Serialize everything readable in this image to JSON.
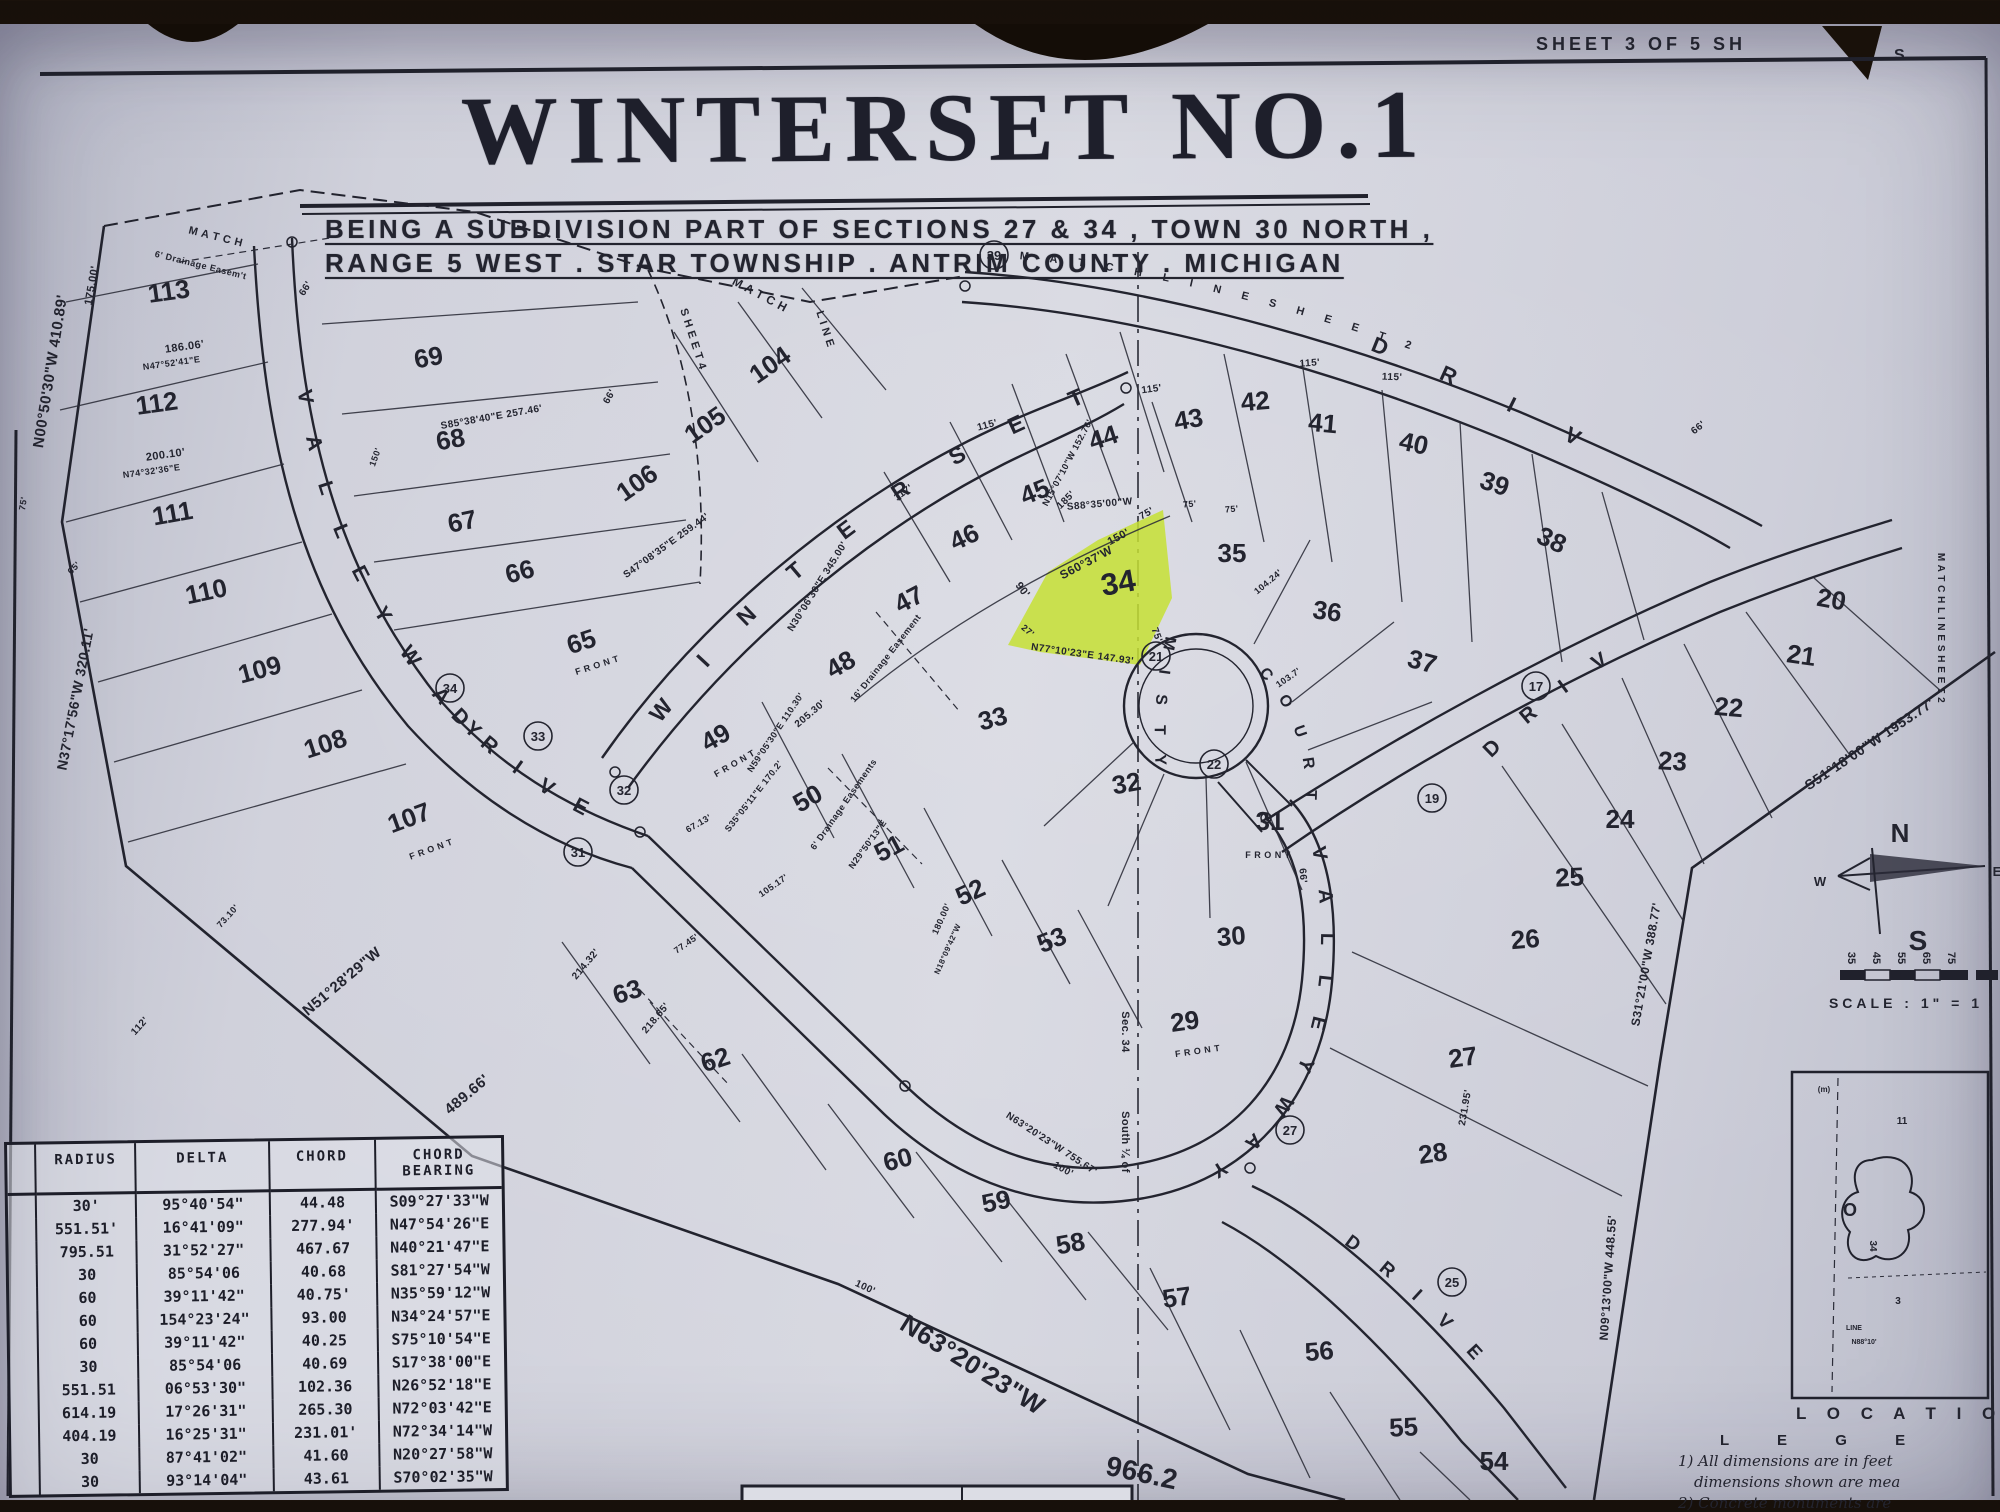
{
  "page": {
    "sheet_label": "SHEET 3 OF 5 SH",
    "sheet_label_torn": "S",
    "title": "WINTERSET NO.1",
    "subtitle_line1": "BEING A SUBDIVISION PART OF SECTIONS 27 & 34 , TOWN 30 NORTH ,",
    "subtitle_line2": "RANGE 5 WEST . STAR TOWNSHIP . ANTRIM COUNTY . MICHIGAN",
    "paper_color": "#d2d3dc",
    "ink_color": "#23242f",
    "highlight_color": "#c6e034"
  },
  "map": {
    "streets": [
      {
        "path": "#lp-left",
        "offset": "8%",
        "size": 21,
        "spacing": 14,
        "label": "V A L L E Y W A Y"
      },
      {
        "path": "#lp-left",
        "offset": "70%",
        "size": 21,
        "spacing": 10,
        "label": "D R I V E"
      },
      {
        "path": "#lp-winterset",
        "offset": "5%",
        "size": 23,
        "spacing": 22,
        "label": "W I N T E R S E T"
      },
      {
        "path": "#lp-match-tr",
        "offset": "2%",
        "size": 11,
        "spacing": 9,
        "label": "M A T C H   L I N E   S H E E T   2"
      },
      {
        "path": "#lp-drive-tr",
        "offset": "8%",
        "size": 22,
        "spacing": 26,
        "label": "D R I V E"
      },
      {
        "path": "#lp-drive-right",
        "offset": "5%",
        "size": 21,
        "spacing": 14,
        "label": "D R I V E"
      },
      {
        "path": "#lp-loop",
        "offset": "2%",
        "size": 20,
        "spacing": 12,
        "label": "V A L L E Y W A Y"
      },
      {
        "path": "#lp-exit",
        "offset": "16%",
        "size": 19,
        "spacing": 12,
        "label": "D R I V E"
      },
      {
        "path": "#lp-misty",
        "offset": "0%",
        "size": 16,
        "spacing": 8,
        "label": "M I S T Y"
      },
      {
        "path": "#lp-court",
        "offset": "4%",
        "size": 16,
        "spacing": 8,
        "label": "C O U R T"
      }
    ],
    "lots": [
      {
        "n": "113",
        "x": 170,
        "y": 300,
        "r": -8
      },
      {
        "n": "112",
        "x": 158,
        "y": 412,
        "r": -8
      },
      {
        "n": "111",
        "x": 174,
        "y": 522,
        "r": -10
      },
      {
        "n": "110",
        "x": 208,
        "y": 600,
        "r": -12
      },
      {
        "n": "109",
        "x": 262,
        "y": 678,
        "r": -15
      },
      {
        "n": "108",
        "x": 328,
        "y": 752,
        "r": -18
      },
      {
        "n": "107",
        "x": 412,
        "y": 826,
        "r": -20
      },
      {
        "n": "69",
        "x": 430,
        "y": 366,
        "r": -10
      },
      {
        "n": "68",
        "x": 452,
        "y": 448,
        "r": -10
      },
      {
        "n": "67",
        "x": 464,
        "y": 530,
        "r": -12
      },
      {
        "n": "66",
        "x": 522,
        "y": 580,
        "r": -15
      },
      {
        "n": "65",
        "x": 584,
        "y": 650,
        "r": -18
      },
      {
        "n": "104",
        "x": 775,
        "y": 372,
        "r": -35
      },
      {
        "n": "105",
        "x": 710,
        "y": 432,
        "r": -35
      },
      {
        "n": "106",
        "x": 642,
        "y": 490,
        "r": -35
      },
      {
        "n": "48",
        "x": 845,
        "y": 672,
        "r": -30
      },
      {
        "n": "47",
        "x": 913,
        "y": 607,
        "r": -28
      },
      {
        "n": "46",
        "x": 968,
        "y": 545,
        "r": -25
      },
      {
        "n": "45",
        "x": 1038,
        "y": 500,
        "r": -22
      },
      {
        "n": "44",
        "x": 1106,
        "y": 446,
        "r": -18
      },
      {
        "n": "43",
        "x": 1190,
        "y": 428,
        "r": -10
      },
      {
        "n": "42",
        "x": 1256,
        "y": 410,
        "r": -5
      },
      {
        "n": "41",
        "x": 1322,
        "y": 432,
        "r": 5
      },
      {
        "n": "40",
        "x": 1412,
        "y": 452,
        "r": 12
      },
      {
        "n": "39",
        "x": 1492,
        "y": 492,
        "r": 18
      },
      {
        "n": "38",
        "x": 1548,
        "y": 548,
        "r": 25
      },
      {
        "n": "35",
        "x": 1232,
        "y": 562,
        "r": 0
      },
      {
        "n": "36",
        "x": 1326,
        "y": 620,
        "r": 8
      },
      {
        "n": "37",
        "x": 1420,
        "y": 670,
        "r": 15
      },
      {
        "n": "34",
        "x": 1120,
        "y": 593,
        "r": -10,
        "s": 31
      },
      {
        "n": "33",
        "x": 995,
        "y": 727,
        "r": -15
      },
      {
        "n": "32",
        "x": 1128,
        "y": 792,
        "r": -10
      },
      {
        "n": "31",
        "x": 1270,
        "y": 830,
        "r": 0
      },
      {
        "n": "30",
        "x": 1232,
        "y": 945,
        "r": -5
      },
      {
        "n": "29",
        "x": 1186,
        "y": 1030,
        "r": -8
      },
      {
        "n": "49",
        "x": 720,
        "y": 745,
        "r": -30
      },
      {
        "n": "50",
        "x": 812,
        "y": 806,
        "r": -30
      },
      {
        "n": "51",
        "x": 893,
        "y": 856,
        "r": -28
      },
      {
        "n": "52",
        "x": 974,
        "y": 900,
        "r": -25
      },
      {
        "n": "53",
        "x": 1055,
        "y": 948,
        "r": -22
      },
      {
        "n": "63",
        "x": 630,
        "y": 1000,
        "r": -18
      },
      {
        "n": "62",
        "x": 718,
        "y": 1068,
        "r": -18
      },
      {
        "n": "60",
        "x": 900,
        "y": 1168,
        "r": -15
      },
      {
        "n": "59",
        "x": 998,
        "y": 1210,
        "r": -12
      },
      {
        "n": "58",
        "x": 1072,
        "y": 1252,
        "r": -10
      },
      {
        "n": "57",
        "x": 1178,
        "y": 1306,
        "r": -8
      },
      {
        "n": "56",
        "x": 1320,
        "y": 1360,
        "r": -5
      },
      {
        "n": "55",
        "x": 1404,
        "y": 1436,
        "r": -3
      },
      {
        "n": "54",
        "x": 1494,
        "y": 1470,
        "r": 0
      },
      {
        "n": "20",
        "x": 1830,
        "y": 608,
        "r": 10
      },
      {
        "n": "21",
        "x": 1800,
        "y": 664,
        "r": 8
      },
      {
        "n": "22",
        "x": 1728,
        "y": 716,
        "r": 5
      },
      {
        "n": "23",
        "x": 1672,
        "y": 770,
        "r": 3
      },
      {
        "n": "24",
        "x": 1620,
        "y": 828,
        "r": 0
      },
      {
        "n": "25",
        "x": 1570,
        "y": 886,
        "r": -3
      },
      {
        "n": "26",
        "x": 1526,
        "y": 948,
        "r": -5
      },
      {
        "n": "27",
        "x": 1464,
        "y": 1066,
        "r": -8
      },
      {
        "n": "28",
        "x": 1434,
        "y": 1162,
        "r": -8
      }
    ],
    "circled": [
      {
        "n": "39",
        "x": 994,
        "y": 255
      },
      {
        "n": "34",
        "x": 450,
        "y": 688
      },
      {
        "n": "33",
        "x": 538,
        "y": 736
      },
      {
        "n": "32",
        "x": 624,
        "y": 790
      },
      {
        "n": "31",
        "x": 578,
        "y": 852
      },
      {
        "n": "21",
        "x": 1156,
        "y": 656
      },
      {
        "n": "22",
        "x": 1214,
        "y": 764
      },
      {
        "n": "17",
        "x": 1536,
        "y": 686
      },
      {
        "n": "19",
        "x": 1432,
        "y": 798
      },
      {
        "n": "25",
        "x": 1452,
        "y": 1282
      },
      {
        "n": "27",
        "x": 1290,
        "y": 1130
      }
    ],
    "labels": [
      {
        "t": "N00°50'30\"W  410.89'",
        "x": 55,
        "y": 372,
        "r": -81,
        "s": 15
      },
      {
        "t": "175.00'",
        "x": 95,
        "y": 286,
        "r": -80,
        "s": 11
      },
      {
        "t": "N37°17'56\"W  320.11'",
        "x": 80,
        "y": 700,
        "r": -79,
        "s": 14
      },
      {
        "t": "N51°28'29\"W",
        "x": 345,
        "y": 985,
        "r": -40,
        "s": 15
      },
      {
        "t": "489.66'",
        "x": 470,
        "y": 1098,
        "r": -40,
        "s": 15
      },
      {
        "t": "N63°20'23\"W",
        "x": 968,
        "y": 1372,
        "r": 32,
        "s": 26
      },
      {
        "t": "966.2",
        "x": 1140,
        "y": 1482,
        "r": 12,
        "s": 28
      },
      {
        "t": "S51°18'00\"W  1953.77'",
        "x": 1872,
        "y": 748,
        "r": -34,
        "s": 14
      },
      {
        "t": "S31°21'00\"W  388.77'",
        "x": 1650,
        "y": 965,
        "r": -80,
        "s": 12
      },
      {
        "t": "N09°13'00\"W  448.55'",
        "x": 1612,
        "y": 1278,
        "r": -86,
        "s": 12
      },
      {
        "t": "M A T C H   L I N E   S H E E T   2",
        "x": 1938,
        "y": 628,
        "r": 90,
        "s": 10
      },
      {
        "t": "S88°35'00\"W",
        "x": 1100,
        "y": 507,
        "r": -5,
        "s": 10
      },
      {
        "t": "75'",
        "x": 1190,
        "y": 507,
        "r": -5,
        "s": 9
      },
      {
        "t": "75'",
        "x": 1232,
        "y": 512,
        "r": -5,
        "s": 9
      },
      {
        "t": "S60°37'W",
        "x": 1088,
        "y": 566,
        "r": -28,
        "s": 12
      },
      {
        "t": "150'",
        "x": 1120,
        "y": 540,
        "r": -28,
        "s": 11
      },
      {
        "t": "75'",
        "x": 1148,
        "y": 516,
        "r": -30,
        "s": 10
      },
      {
        "t": "N77°10'23\"E  147.93'",
        "x": 1082,
        "y": 657,
        "r": 8,
        "s": 10
      },
      {
        "t": "90'",
        "x": 1020,
        "y": 592,
        "r": 52,
        "s": 11
      },
      {
        "t": "27'",
        "x": 1026,
        "y": 633,
        "r": 40,
        "s": 9
      },
      {
        "t": "75'",
        "x": 1154,
        "y": 636,
        "r": 70,
        "s": 10
      },
      {
        "t": "F R O N T",
        "x": 432,
        "y": 852,
        "r": -20,
        "s": 9
      },
      {
        "t": "F R O N T",
        "x": 598,
        "y": 668,
        "r": -18,
        "s": 9
      },
      {
        "t": "F R O N T",
        "x": 736,
        "y": 766,
        "r": -30,
        "s": 9
      },
      {
        "t": "F R O N T",
        "x": 1268,
        "y": 858,
        "r": 0,
        "s": 9
      },
      {
        "t": "F R O N T",
        "x": 1198,
        "y": 1054,
        "r": -8,
        "s": 9
      },
      {
        "t": "M A T C H",
        "x": 215,
        "y": 240,
        "r": 14,
        "s": 11
      },
      {
        "t": "M A T C H",
        "x": 758,
        "y": 298,
        "r": 28,
        "s": 12
      },
      {
        "t": "S H E E T  4",
        "x": 690,
        "y": 340,
        "r": 72,
        "s": 11
      },
      {
        "t": "L I N E",
        "x": 822,
        "y": 330,
        "r": 72,
        "s": 11
      },
      {
        "t": "6' Drainage Easem't",
        "x": 200,
        "y": 268,
        "r": 14,
        "s": 9
      },
      {
        "t": "6' Drainage Easements",
        "x": 846,
        "y": 806,
        "r": -55,
        "s": 9
      },
      {
        "t": "16' Drainage Easement",
        "x": 888,
        "y": 660,
        "r": -52,
        "s": 9
      },
      {
        "t": "Sec. 34",
        "x": 1122,
        "y": 1032,
        "r": 90,
        "s": 11
      },
      {
        "t": "South ¼ of",
        "x": 1122,
        "y": 1142,
        "r": 90,
        "s": 11
      },
      {
        "t": "N63°20'23\"W  755.67'",
        "x": 1050,
        "y": 1146,
        "r": 33,
        "s": 10
      },
      {
        "t": "S85°38'40\"E  257.46'",
        "x": 492,
        "y": 420,
        "r": -10,
        "s": 10
      },
      {
        "t": "S47°08'35\"E  259.44'",
        "x": 668,
        "y": 548,
        "r": -36,
        "s": 10
      },
      {
        "t": "N30°06'30\"E  345.00'",
        "x": 820,
        "y": 588,
        "r": -58,
        "s": 10
      },
      {
        "t": "185'",
        "x": 1068,
        "y": 502,
        "r": -45,
        "s": 10
      },
      {
        "t": "N15°07'10\"W  152.76'",
        "x": 1070,
        "y": 464,
        "r": -62,
        "s": 9
      },
      {
        "t": "115'",
        "x": 988,
        "y": 428,
        "r": -15,
        "s": 10
      },
      {
        "t": "115'",
        "x": 1152,
        "y": 392,
        "r": -8,
        "s": 10
      },
      {
        "t": "115'",
        "x": 1310,
        "y": 366,
        "r": -4,
        "s": 10
      },
      {
        "t": "115'",
        "x": 1392,
        "y": 380,
        "r": 2,
        "s": 10
      },
      {
        "t": "117'",
        "x": 905,
        "y": 495,
        "r": -35,
        "s": 10
      },
      {
        "t": "205.30'",
        "x": 812,
        "y": 716,
        "r": -40,
        "s": 10
      },
      {
        "t": "N59°05'30\"E  110.30'",
        "x": 778,
        "y": 734,
        "r": -56,
        "s": 9
      },
      {
        "t": "S35°05'11\"E  170.2'",
        "x": 756,
        "y": 798,
        "r": -52,
        "s": 9
      },
      {
        "t": "67.13'",
        "x": 700,
        "y": 826,
        "r": -30,
        "s": 9
      },
      {
        "t": "N29°50'13\"E",
        "x": 870,
        "y": 846,
        "r": -54,
        "s": 9
      },
      {
        "t": "77.45'",
        "x": 688,
        "y": 946,
        "r": -35,
        "s": 9
      },
      {
        "t": "214.32'",
        "x": 588,
        "y": 966,
        "r": -50,
        "s": 10
      },
      {
        "t": "218.65'",
        "x": 658,
        "y": 1020,
        "r": -50,
        "s": 10
      },
      {
        "t": "100'",
        "x": 864,
        "y": 1290,
        "r": 25,
        "s": 10
      },
      {
        "t": "100'",
        "x": 1062,
        "y": 1172,
        "r": 28,
        "s": 10
      },
      {
        "t": "180.00'",
        "x": 944,
        "y": 920,
        "r": -66,
        "s": 9
      },
      {
        "t": "105.17'",
        "x": 775,
        "y": 888,
        "r": -35,
        "s": 9
      },
      {
        "t": "N18°09'42\"W",
        "x": 950,
        "y": 950,
        "r": -66,
        "s": 8
      },
      {
        "t": "231.95'",
        "x": 1468,
        "y": 1108,
        "r": -80,
        "s": 10
      },
      {
        "t": "73.10'",
        "x": 230,
        "y": 918,
        "r": -48,
        "s": 9
      },
      {
        "t": "112'",
        "x": 142,
        "y": 1028,
        "r": -48,
        "s": 10
      },
      {
        "t": "75'",
        "x": 26,
        "y": 504,
        "r": -80,
        "s": 9
      },
      {
        "t": "65'",
        "x": 76,
        "y": 570,
        "r": -45,
        "s": 9
      },
      {
        "t": "66'",
        "x": 308,
        "y": 290,
        "r": -58,
        "s": 10
      },
      {
        "t": "66'",
        "x": 612,
        "y": 398,
        "r": -60,
        "s": 10
      },
      {
        "t": "66'",
        "x": 1300,
        "y": 876,
        "r": 85,
        "s": 10
      },
      {
        "t": "66'",
        "x": 1700,
        "y": 430,
        "r": -38,
        "s": 10
      },
      {
        "t": "104.24'",
        "x": 1270,
        "y": 584,
        "r": -40,
        "s": 9
      },
      {
        "t": "103.7'",
        "x": 1290,
        "y": 680,
        "r": -35,
        "s": 9
      },
      {
        "t": "N74°32'36\"E",
        "x": 152,
        "y": 474,
        "r": -8,
        "s": 9
      },
      {
        "t": "200.10'",
        "x": 166,
        "y": 458,
        "r": -8,
        "s": 11
      },
      {
        "t": "N47°52'41\"E",
        "x": 172,
        "y": 366,
        "r": -8,
        "s": 9
      },
      {
        "t": "186.06'",
        "x": 185,
        "y": 350,
        "r": -8,
        "s": 11
      },
      {
        "t": "150'",
        "x": 378,
        "y": 458,
        "r": -70,
        "s": 9
      }
    ],
    "compass": {
      "n": "N",
      "s": "S",
      "w": "W",
      "e": "E"
    },
    "scale_ticks": [
      "35",
      "45",
      "55",
      "65",
      "75"
    ],
    "scale_label": "SCALE : 1\" = 1",
    "curve_table": {
      "headers": [
        "",
        "RADIUS",
        "DELTA",
        "CHORD",
        "CHORD BEARING"
      ],
      "rows": [
        [
          "",
          "30'",
          "95°40'54\"",
          "44.48",
          "S09°27'33\"W"
        ],
        [
          "",
          "551.51'",
          "16°41'09\"",
          "277.94'",
          "N47°54'26\"E"
        ],
        [
          "",
          "795.51",
          "31°52'27\"",
          "467.67",
          "N40°21'47\"E"
        ],
        [
          "",
          "30",
          "85°54'06",
          "40.68",
          "S81°27'54\"W"
        ],
        [
          "",
          "60",
          "39°11'42\"",
          "40.75'",
          "N35°59'12\"W"
        ],
        [
          "",
          "60",
          "154°23'24\"",
          "93.00",
          "N34°24'57\"E"
        ],
        [
          "",
          "60",
          "39°11'42\"",
          "40.25",
          "S75°10'54\"E"
        ],
        [
          "",
          "30",
          "85°54'06",
          "40.69",
          "S17°38'00\"E"
        ],
        [
          "",
          "551.51",
          "06°53'30\"",
          "102.36",
          "N26°52'18\"E"
        ],
        [
          "",
          "614.19",
          "17°26'31\"",
          "265.30",
          "N72°03'42\"E"
        ],
        [
          "",
          "404.19",
          "16°25'31\"",
          "231.01'",
          "N72°34'14\"W"
        ],
        [
          "",
          "30",
          "87°41'02\"",
          "41.60",
          "N20°27'58\"W"
        ],
        [
          "",
          "30",
          "93°14'04\"",
          "43.61",
          "S70°02'35\"W"
        ]
      ]
    },
    "inset": {
      "location_label": "L O C A T I O",
      "legend_label": "L E G E",
      "notes": [
        "1) All dimensions are in feet",
        "dimensions shown are mea",
        "2) Concrete monuments are"
      ],
      "texts": [
        {
          "t": "11",
          "x": 1902,
          "y": 1124,
          "r": 0,
          "s": 10
        },
        {
          "t": "(m)",
          "x": 1824,
          "y": 1092,
          "r": 0,
          "s": 8
        },
        {
          "t": "O",
          "x": 1850,
          "y": 1216,
          "r": 0,
          "s": 18
        },
        {
          "t": "34",
          "x": 1870,
          "y": 1246,
          "r": 90,
          "s": 10
        },
        {
          "t": "3",
          "x": 1898,
          "y": 1304,
          "r": 0,
          "s": 10
        },
        {
          "t": "LINE",
          "x": 1854,
          "y": 1330,
          "r": 0,
          "s": 7
        },
        {
          "t": "N88°10'",
          "x": 1864,
          "y": 1344,
          "r": 0,
          "s": 7
        }
      ]
    }
  }
}
